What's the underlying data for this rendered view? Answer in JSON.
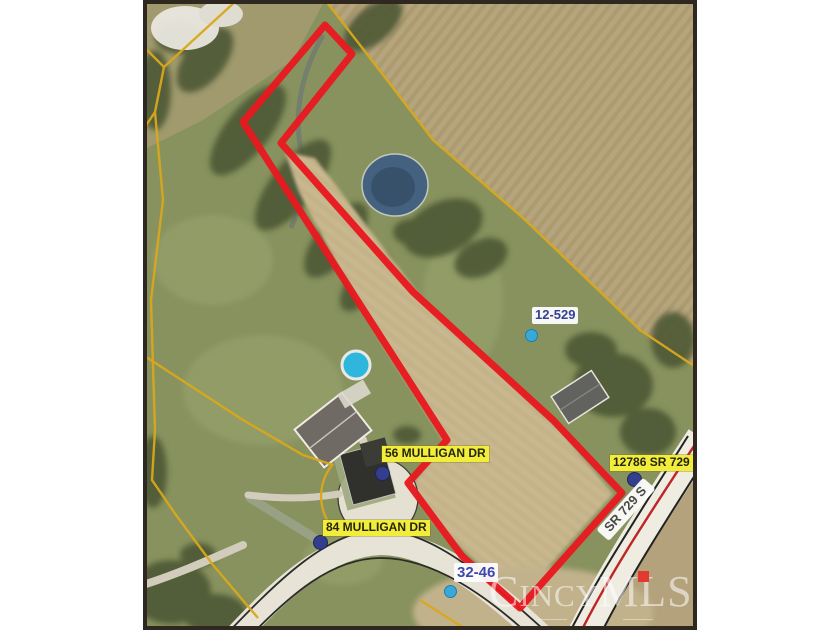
{
  "map": {
    "description": "Aerial parcel map photo with outlined property boundary",
    "boundary_color": "#e8191f",
    "parcel_line_color": "#d9a81c",
    "labels": {
      "parcel_12_529": "12-529",
      "parcel_32_46": "32-46",
      "address_56_mulligan": "56 MULLIGAN DR",
      "address_84_mulligan": "84 MULLIGAN DR",
      "address_12786_sr": "12786 SR 729",
      "road_sr_729": "SR 729 S"
    },
    "watermark": {
      "brand": "CincyMLS",
      "dot_color": "#e23a30"
    }
  }
}
